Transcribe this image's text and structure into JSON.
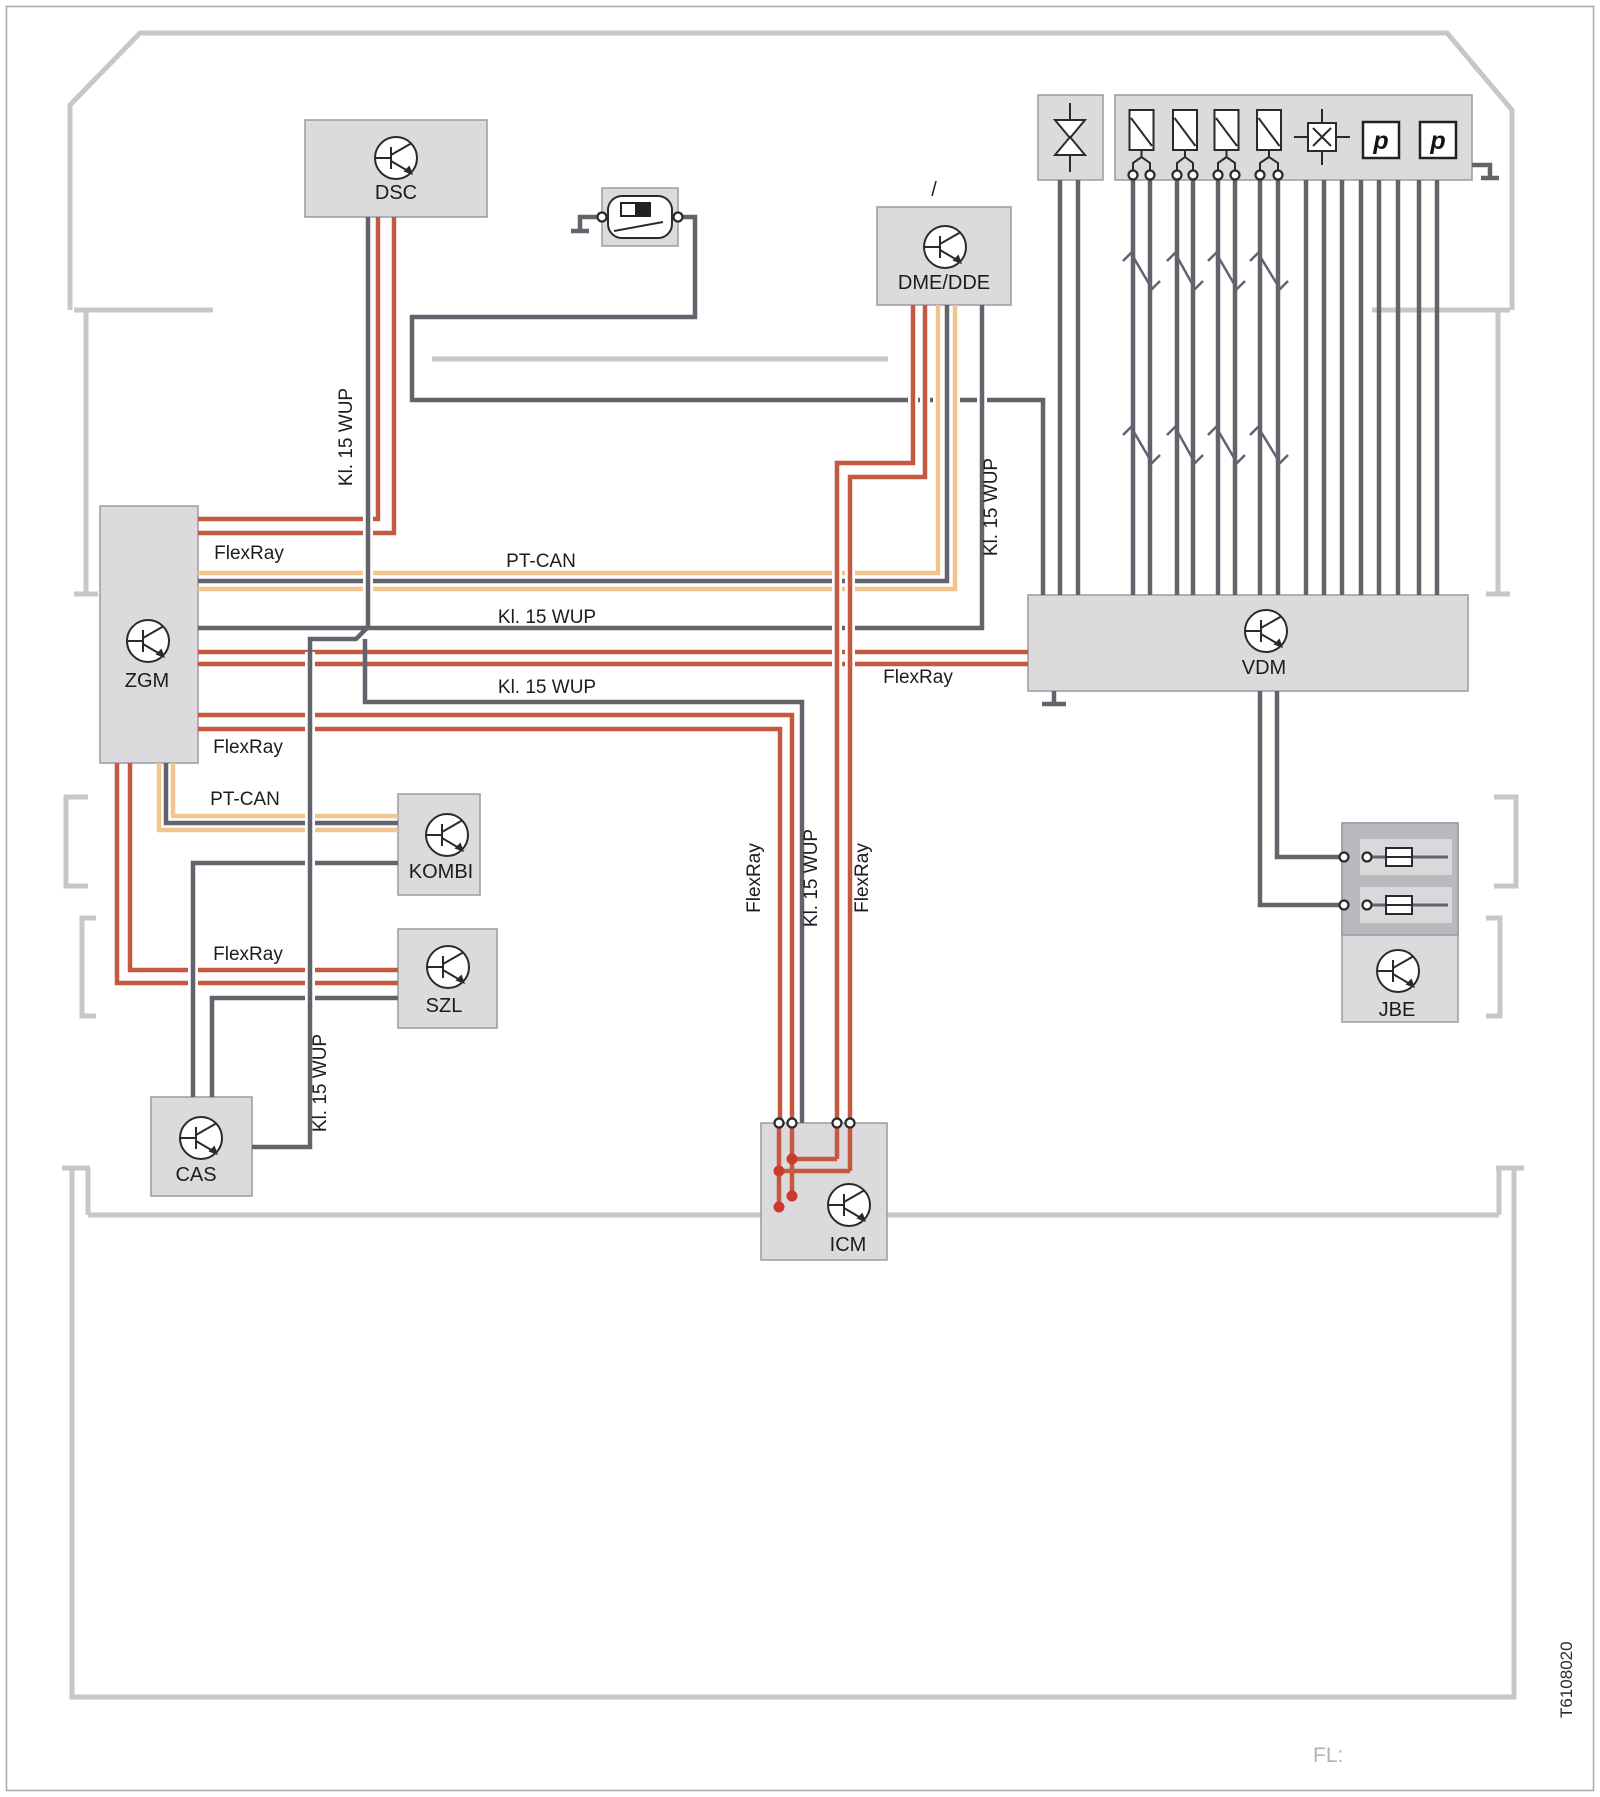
{
  "page": {
    "doc_number": "T6108020",
    "footer_label": "FL:"
  },
  "modules": {
    "dsc": "DSC",
    "dme_dde": "DME/DDE",
    "dme_slash": "/",
    "zgm": "ZGM",
    "kombi": "KOMBI",
    "szl": "SZL",
    "cas": "CAS",
    "icm": "ICM",
    "vdm": "VDM",
    "jbe": "JBE"
  },
  "sensors": {
    "pressure_label": "p"
  },
  "wire_labels": [
    {
      "text": "FlexRay"
    },
    {
      "text": "PT-CAN"
    },
    {
      "text": "Kl. 15 WUP"
    },
    {
      "text": "FlexRay"
    },
    {
      "text": "Kl. 15 WUP"
    },
    {
      "text": "FlexRay"
    },
    {
      "text": "PT-CAN"
    },
    {
      "text": "FlexRay"
    },
    {
      "text": "Kl. 15 WUP"
    },
    {
      "text": "Kl. 15 WUP"
    },
    {
      "text": "FlexRay"
    },
    {
      "text": "Kl. 15 WUP"
    },
    {
      "text": "FlexRay"
    },
    {
      "text": "Kl. 15 WUP"
    }
  ],
  "colors": {
    "flexray_red": "#c4593f",
    "pt_can_beige": "#f2c48e",
    "wire_gray": "#63636b",
    "body_outline": "#c7c7c9",
    "module_fill": "#dbdbdd",
    "module_border": "#9a9aa0"
  }
}
